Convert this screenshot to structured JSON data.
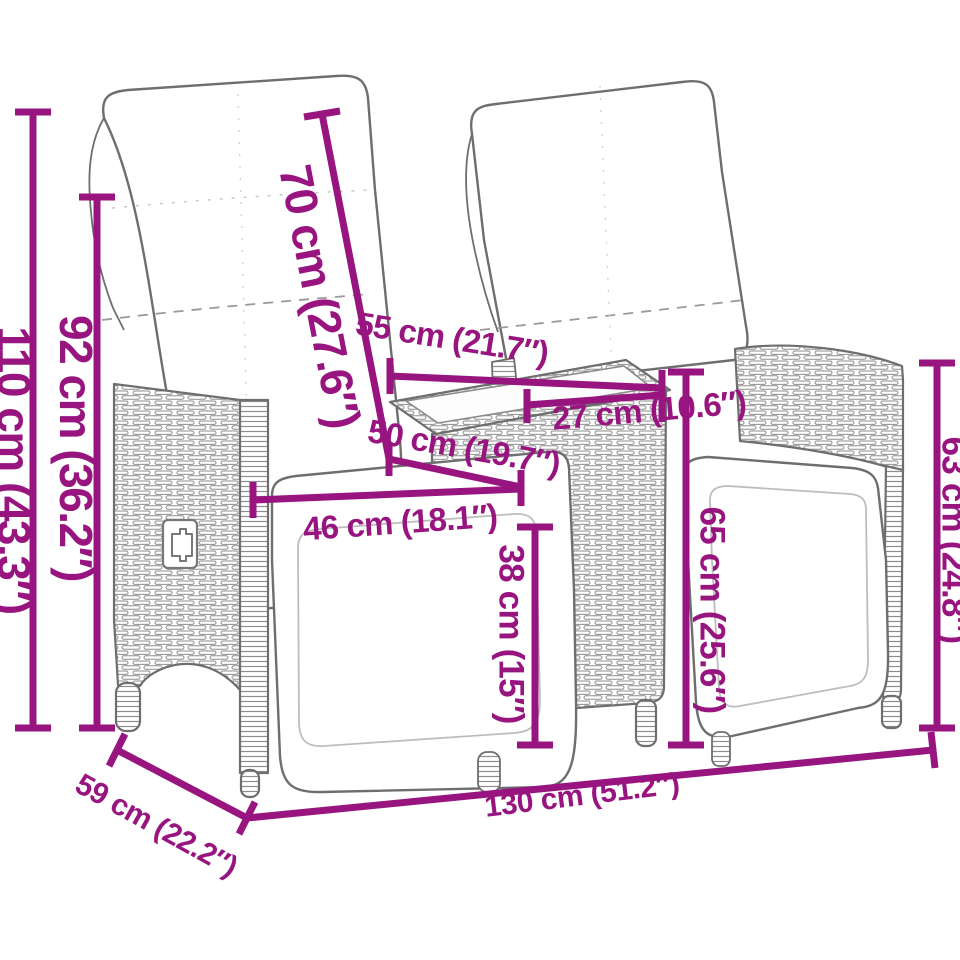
{
  "description": "Dimension diagram of a 2-seater reclining rattan garden sofa with centre wicker table, white cushions, magenta measurement callouts",
  "colors": {
    "accent": "#981580",
    "line_art": "#6e6e6e",
    "wicker": "#8d8d8d",
    "background": "#ffffff"
  },
  "dimensions": {
    "total_height": "110 cm (43.3″)",
    "backrest_height_from_ground": "92 cm (36.2″)",
    "backrest_length": "70 cm (27.6″)",
    "table_length": "55 cm (21.7″)",
    "table_width": "27 cm (10.6″)",
    "seat_depth": "50 cm (19.7″)",
    "seat_width": "46 cm (18.1″)",
    "seat_height": "38 cm (15″)",
    "table_height": "65 cm (25.6″)",
    "armrest_height": "63 cm (24.8″)",
    "seat_unit_depth": "59 cm (22.2″)",
    "total_width": "130 cm (51.2″)"
  }
}
